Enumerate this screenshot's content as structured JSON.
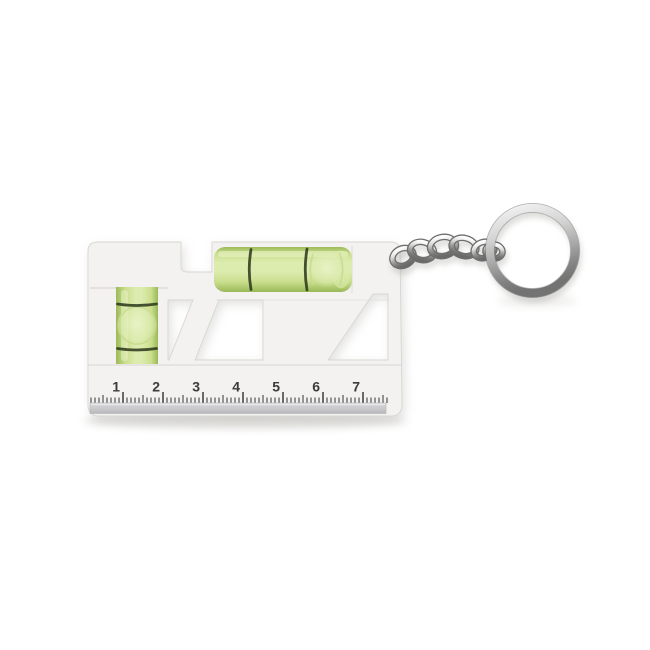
{
  "meta": {
    "description": "Product photo of a white mini spirit level keychain with a measuring ruler, two green bubble vials and a silver chain with split key ring",
    "background_color": "#ffffff"
  },
  "product": {
    "body_color": "#f3f2f0",
    "edge_color": "#d9d6d1",
    "vials": {
      "glass_light": "#dcebae",
      "glass_mid": "#c9de8c",
      "glass_dark": "#9ab857",
      "marking_color": "#2e3b1f",
      "horizontal_vial": {
        "markings": 2,
        "bubble": "right of center"
      },
      "vertical_vial": {
        "markings": 2,
        "bubble": "centered"
      }
    },
    "ruler": {
      "numbers": [
        "1",
        "2",
        "3",
        "4",
        "5",
        "6",
        "7"
      ],
      "minor_ticks_per_unit": 10,
      "number_color": "#3b3b3b",
      "edge_strip_color": "#c7c6c8"
    },
    "keychain": {
      "visible_links": 6,
      "metal_light": "#f4f4f4",
      "metal_dark": "#6d6d6d",
      "type": "split ring"
    }
  }
}
